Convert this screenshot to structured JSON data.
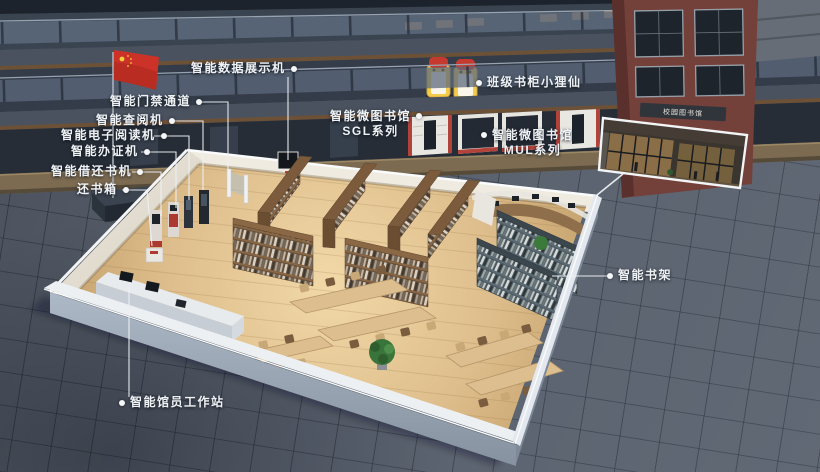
{
  "scene": {
    "storefront_sign": "校园图书馆"
  },
  "labels": {
    "data_display": "智能数据展示机",
    "class_cabinet": "班级书柜小狸仙",
    "access_gate": "智能门禁通道",
    "inquiry_machine": "智能查阅机",
    "ereader_machine": "智能电子阅读机",
    "card_machine": "智能办证机",
    "borrow_return_machine": "智能借还书机",
    "return_box": "还书箱",
    "micro_library_sgl_line1": "智能微图书馆",
    "micro_library_sgl_line2": "SGL系列",
    "micro_library_mul_line1": "智能微图书馆",
    "micro_library_mul_line2": "MUL系列",
    "smart_shelf": "智能书架",
    "workstation": "智能馆员工作站"
  },
  "colors": {
    "label_text": "#eff2f5",
    "flag_red": "#c7372a",
    "wood_floor": "#e3c291",
    "front_wall": "#9aa6b6",
    "plaza_tile": "#59616e",
    "brick": "#74403a",
    "accent_red": "#b2433a",
    "smart_shelf_teal": "#4b585f"
  }
}
